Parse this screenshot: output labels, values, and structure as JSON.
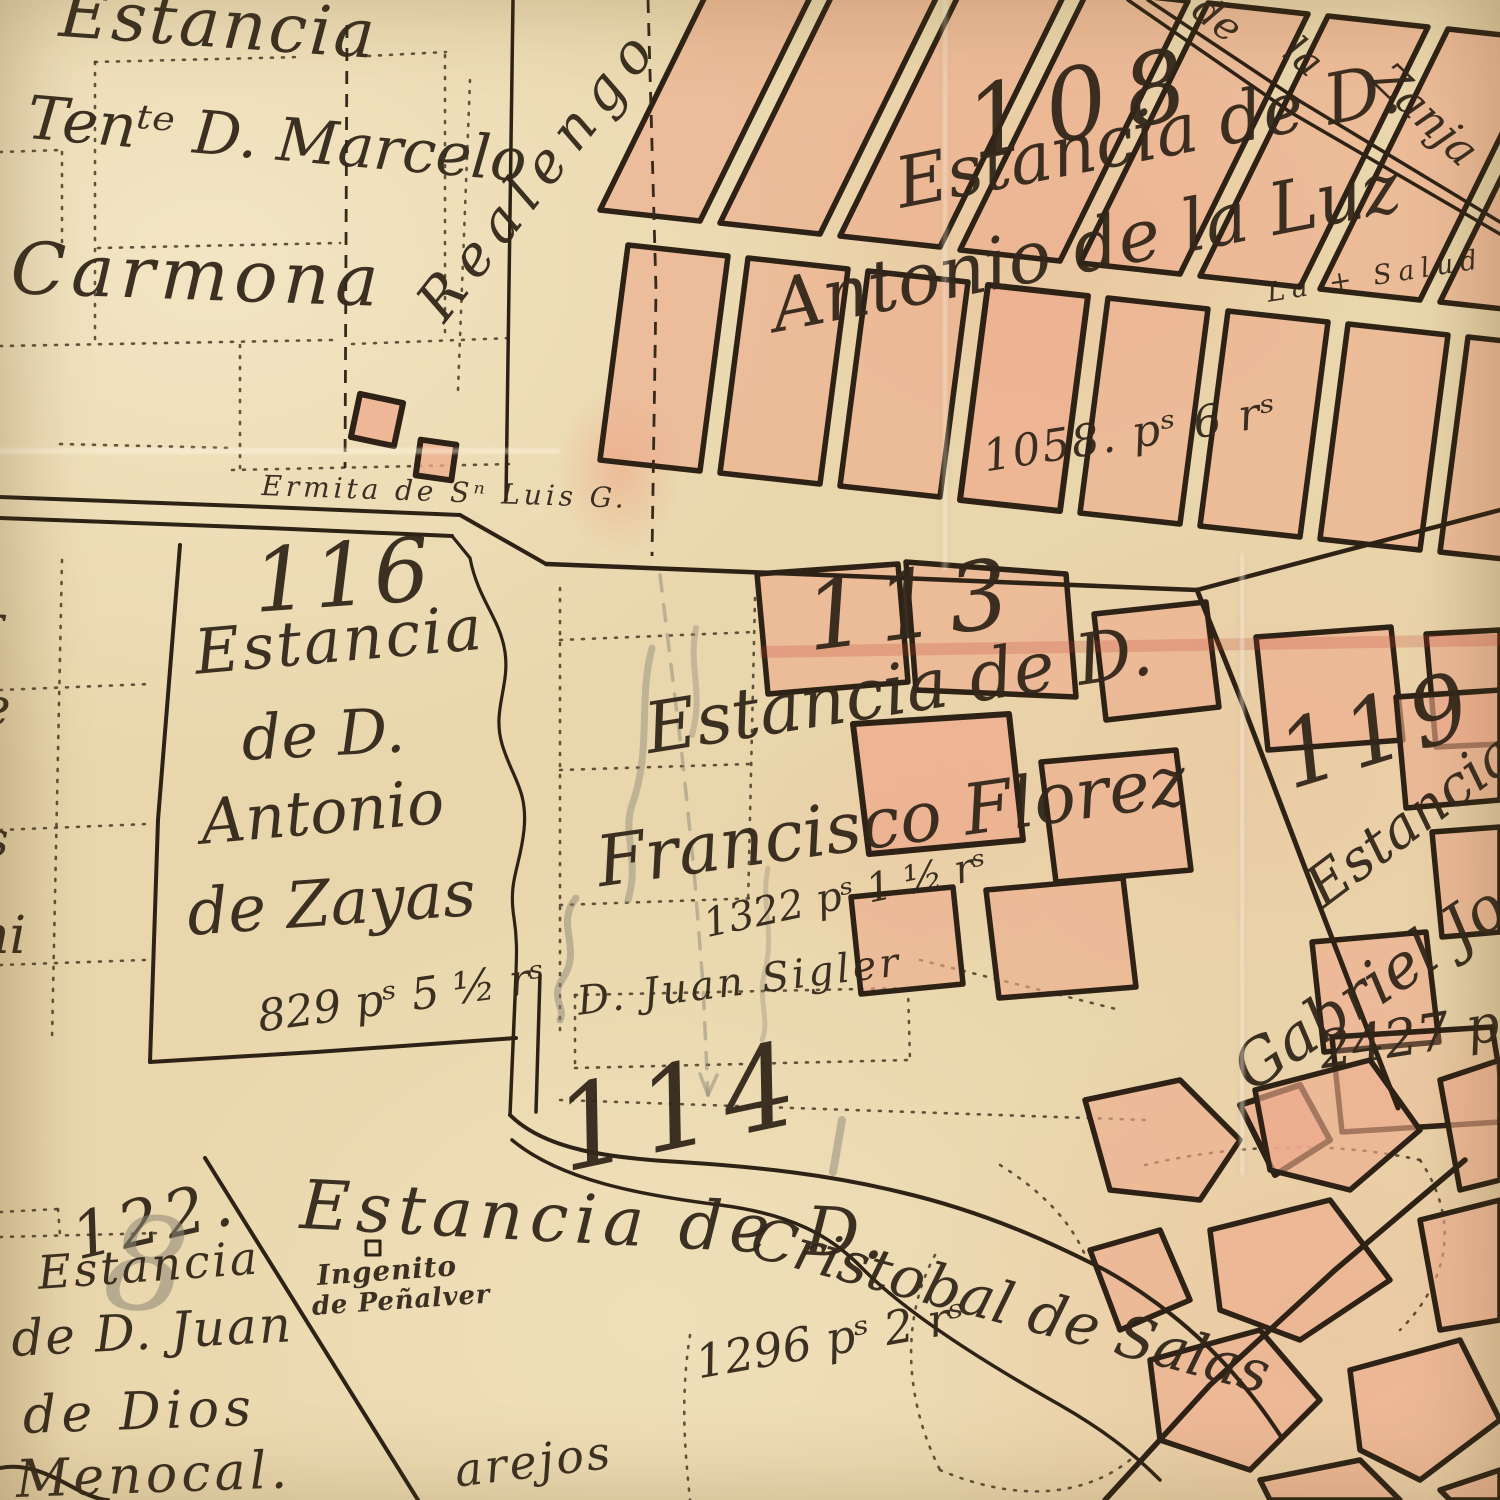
{
  "map_type": "historical-cadastral-map",
  "language": "Spanish",
  "colors": {
    "paper": "#e9d6ac",
    "ink": "#2d2215",
    "parcel_fill": "#eeab8c",
    "pencil": "#8e8777"
  },
  "estates": {
    "carmona": {
      "line1": "Estancia",
      "line2": "Tenᵗᵉ D. Marcelo",
      "line3": "Carmona"
    },
    "e108": {
      "num": "108",
      "line1": "Estancia de D.",
      "line2": "Antonio de la Luz",
      "area": "1058. pˢ 6 rˢ",
      "note": "La + Salud"
    },
    "e113": {
      "num": "113",
      "line1": "Estancia de D.",
      "line2": "Francisco Florez",
      "area": "1322 pˢ 1 ½ rˢ",
      "tenant": "D. Juan Sigler"
    },
    "e116": {
      "num": "116",
      "line1": "Estancia",
      "line2": "de D.",
      "line3": "Antonio",
      "line4": "de Zayas",
      "area": "829 pˢ 5 ½ rˢ"
    },
    "e119": {
      "num": "119",
      "line1": "Estancia",
      "line2": "Gabriel Jos",
      "area": "2427 p"
    },
    "e114": {
      "num": "114",
      "line1": "Estancia de D.",
      "line2": "Cristobal de Salas",
      "area": "1296 pˢ 2 rˢ"
    },
    "e122": {
      "num": "122.",
      "pencil": "8",
      "line1": "Estancia",
      "line2": "de D. Juan",
      "line3": "de Dios",
      "line4": "Menocal."
    }
  },
  "features": {
    "realengo": "Realengo",
    "ermita": "Ermita de Sⁿ Luis G.",
    "zanja": {
      "de": "de",
      "la": "la",
      "name": "Zanja"
    },
    "ingenio": {
      "line1": "Ingenito",
      "line2": "de Peñalver"
    }
  },
  "fragments": {
    "left_top": "l",
    "left_r": "r",
    "left_e": "e",
    "left_s": "s",
    "left_ni": "ni",
    "bottom": "arejos"
  }
}
